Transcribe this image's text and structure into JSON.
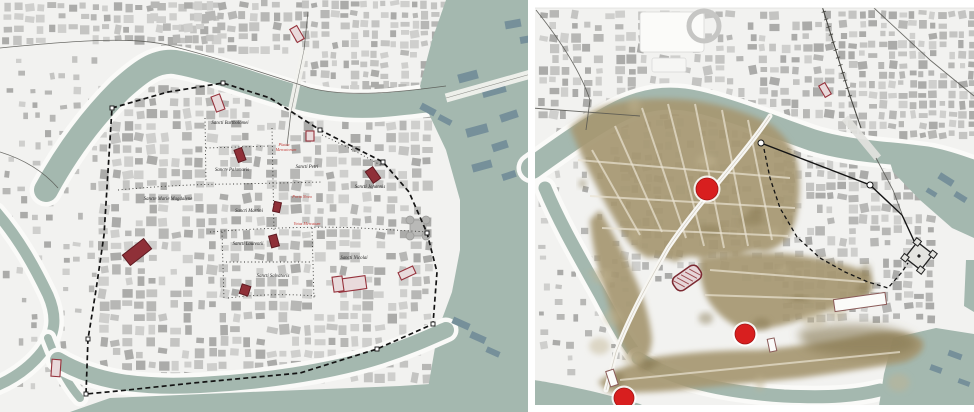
{
  "figure": {
    "kind": "historical-city-map-comparison",
    "panel_count": 2
  },
  "colors": {
    "land": "#f2f2f0",
    "water": "#a4b8af",
    "water_dark": "#7e97a0",
    "bank": "#fafaf8",
    "building_palette": [
      "#cfcfcd",
      "#c4c4c2",
      "#b7b7b5",
      "#ababa9"
    ],
    "building_dark_teal": "#76909a",
    "sepia": "#a79872",
    "sepia_dark": "#86774f",
    "sepia_street": "#eae3d1",
    "church_fill": "#8f3038",
    "church_stroke": "#5f1b22",
    "red_outline": "#96323c",
    "marker_red": "#d81f1f",
    "label_black": "#1e1e1e",
    "label_red": "#c33a35",
    "wall": "#141414",
    "road": "#555550",
    "divider": "#ffffff"
  },
  "left_panel": {
    "name": "medieval-parish-map",
    "labels": [
      {
        "text": "Sancti Bartholomei",
        "x": 230,
        "y": 124,
        "red": false
      },
      {
        "text": "Sancte Palamaris",
        "x": 232,
        "y": 171,
        "red": false
      },
      {
        "text": "Sancti Petri",
        "x": 307,
        "y": 168,
        "red": false
      },
      {
        "text": "Sancti Johannis",
        "x": 370,
        "y": 188,
        "red": false
      },
      {
        "text": "Sancte Marie Magdalene",
        "x": 168,
        "y": 200,
        "red": false
      },
      {
        "text": "Sancti Martini",
        "x": 249,
        "y": 212,
        "red": false
      },
      {
        "text": "Sancti Laurentii",
        "x": 248,
        "y": 245,
        "red": false
      },
      {
        "text": "Sancti Salvatoris",
        "x": 273,
        "y": 277,
        "red": false
      },
      {
        "text": "Sancti Nicolai",
        "x": 354,
        "y": 259,
        "red": false
      },
      {
        "text": "Platea",
        "x": 284,
        "y": 146,
        "red": true
      },
      {
        "text": "Mercatorum",
        "x": 286,
        "y": 151,
        "red": true
      },
      {
        "text": "Porta Nova",
        "x": 302,
        "y": 198,
        "red": true
      },
      {
        "text": "Vetus Mercatum",
        "x": 307,
        "y": 225,
        "red": true
      }
    ],
    "wall_path": "M112,108 L168,92 L223,83 L270,98 L320,130 L383,162 L409,192 L427,233 L437,272 L433,324 L377,349 L300,373 L193,383 L118,391 L86,394 L88,339 L96,290 L104,235 Z",
    "wall_markers": [
      [
        112,
        108
      ],
      [
        223,
        83
      ],
      [
        320,
        130
      ],
      [
        383,
        162
      ],
      [
        427,
        233
      ],
      [
        433,
        324
      ],
      [
        377,
        349
      ],
      [
        86,
        394
      ],
      [
        88,
        339
      ]
    ],
    "dotted_lines": [
      "M205,118 L206,182",
      "M118,190 C160,186 200,184 238,184 L322,182",
      "M272,128 L274,232",
      "M210,232 C260,228 320,226 360,228 L428,232",
      "M222,232 L224,300",
      "M312,228 L314,300",
      "M226,262 L310,262",
      "M228,298 C260,294 290,294 316,296",
      "M322,135 C350,148 368,158 382,166",
      "M206,148 L270,146"
    ],
    "water": {
      "main_river": "M46,190 C65,155 90,120 120,90 C140,72 155,60 175,62 C210,68 250,84 300,98 C330,106 360,108 395,104 C415,102 430,100 448,98",
      "east_body": "M446,0 L531,0 L531,412 L424,412 L438,330 L452,292 L460,250 L460,200 L446,150 L428,112 L420,86 L432,40 Z",
      "west_channel": "M-4,212 C20,240 35,268 48,295 C58,318 55,335 42,352 C30,367 15,378 -4,386",
      "channel_link": "M48,338 C58,364 66,382 80,398",
      "south_moat": "M58,360 C95,382 140,388 200,385 C260,382 330,372 380,356 C408,347 428,338 446,330",
      "south_edge": "M70,412 L110,398 L250,392 L400,386 L460,382 L531,384 L531,412 Z"
    },
    "bridges": [
      {
        "path": "M304,50 L291,112",
        "w": 7
      },
      {
        "path": "M446,98 L531,74",
        "w": 9
      }
    ],
    "roads": [
      "M0,48 C80,40 140,36 175,47 C215,57 260,72 310,88 C350,98 400,92 446,86",
      "M308,12 L304,50",
      "M291,112 L287,146",
      "M0,152 C26,160 44,172 58,188"
    ],
    "churches_filled": [
      {
        "x": 137,
        "y": 252,
        "w": 27,
        "h": 13,
        "r": -38
      },
      {
        "x": 240,
        "y": 155,
        "w": 8,
        "h": 13,
        "r": -20
      },
      {
        "x": 277,
        "y": 207,
        "w": 7,
        "h": 10,
        "r": 12
      },
      {
        "x": 274,
        "y": 241,
        "w": 8,
        "h": 12,
        "r": -15
      },
      {
        "x": 245,
        "y": 290,
        "w": 9,
        "h": 10,
        "r": 18
      },
      {
        "x": 373,
        "y": 175,
        "w": 9,
        "h": 14,
        "r": -35
      }
    ],
    "churches_outline": [
      {
        "x": 218,
        "y": 103,
        "w": 9,
        "h": 16,
        "r": -20
      },
      {
        "x": 297,
        "y": 34,
        "w": 8,
        "h": 15,
        "r": -30
      },
      {
        "x": 310,
        "y": 136,
        "w": 8,
        "h": 10,
        "r": 0
      },
      {
        "x": 56,
        "y": 368,
        "w": 9,
        "h": 17,
        "r": 4
      },
      {
        "x": 407,
        "y": 273,
        "w": 16,
        "h": 8,
        "r": -25
      },
      {
        "x": 352,
        "y": 284,
        "w": 28,
        "h": 13,
        "r": -8
      },
      {
        "x": 338,
        "y": 284,
        "w": 10,
        "h": 15,
        "r": -8
      }
    ],
    "dark_water_buildings": [
      [
        458,
        72,
        20,
        9,
        -15
      ],
      [
        482,
        86,
        24,
        9,
        -15
      ],
      [
        500,
        112,
        18,
        8,
        -18
      ],
      [
        466,
        126,
        22,
        9,
        -15
      ],
      [
        492,
        142,
        16,
        8,
        -18
      ],
      [
        472,
        162,
        20,
        8,
        -15
      ],
      [
        502,
        172,
        14,
        7,
        -18
      ],
      [
        420,
        106,
        16,
        7,
        28
      ],
      [
        438,
        117,
        14,
        6,
        28
      ],
      [
        452,
        320,
        18,
        7,
        24
      ],
      [
        470,
        334,
        16,
        7,
        24
      ],
      [
        486,
        349,
        14,
        6,
        24
      ],
      [
        505,
        20,
        16,
        8,
        -10
      ],
      [
        520,
        36,
        12,
        7,
        -10
      ]
    ],
    "castle": {
      "x": 418,
      "y": 228
    }
  },
  "right_panel": {
    "name": "aerial-overlay-map",
    "markers": [
      {
        "x": 707,
        "y": 189,
        "r": 11
      },
      {
        "x": 745,
        "y": 334,
        "r": 10
      },
      {
        "x": 624,
        "y": 398,
        "r": 10
      }
    ],
    "hatched_church": {
      "x": 687,
      "y": 278,
      "w": 30,
      "h": 16,
      "r": -35
    },
    "churches_outline": [
      {
        "x": 825,
        "y": 90,
        "w": 7,
        "h": 13,
        "r": -30
      }
    ],
    "white_buildings": [
      {
        "x": 612,
        "y": 378,
        "w": 8,
        "h": 16,
        "r": -18
      },
      {
        "x": 772,
        "y": 345,
        "w": 7,
        "h": 13,
        "r": -12
      },
      {
        "x": 860,
        "y": 302,
        "w": 52,
        "h": 12,
        "r": -8
      }
    ],
    "wall_solid": "M761,143 L870,185 L902,215 L915,243",
    "wall_solid_markers": [
      [
        761,
        143
      ],
      [
        870,
        185
      ]
    ],
    "wall_dashed": "M764,149 L770,178 L780,208 L797,237 L820,258 L845,272 L868,282 L888,288 L902,272 L908,263",
    "citadel": {
      "x": 919,
      "y": 256,
      "size": 20,
      "rot": 38
    },
    "water": {
      "main_river": "M532,168 C560,148 588,128 614,114 C642,99 668,95 698,102 C732,110 772,126 812,140 C850,152 890,152 930,158 C950,162 965,168 976,172",
      "main_end": "M885,146 L930,150 L974,164 L974,238 L952,228 L920,200 L893,172 Z",
      "west_arm": "M545,188 C560,224 580,258 600,294 C614,320 625,342 640,360",
      "south_arm": "M638,358 C676,382 724,392 784,396 C830,398 856,396 880,390",
      "southwest_edge": "M534,412 L534,380 C560,384 600,392 640,404 L656,412 Z",
      "east_strip": "M966,260 L974,260 L974,312 L964,306 Z",
      "southeast_body": "M893,338 L936,328 L974,334 L974,412 L878,412 L884,374 Z"
    },
    "sepia_regions": [
      "M570,128 Q585,112 610,104 Q645,96 690,100 Q735,106 770,124 Q792,140 798,165 Q802,195 795,222 Q788,246 765,252 Q748,248 738,258 Q720,252 705,260 Q688,252 676,262 Q660,255 648,258 Q632,250 622,232 Q608,210 596,185 Q582,158 570,128 Z",
      "M600,210 Q622,248 638,285 Q650,315 652,340 Q650,358 640,368 Q628,360 620,340 Q610,310 600,275 Q592,245 590,220 Z",
      "M700,258 Q740,250 790,254 Q835,260 868,272 Q880,286 862,300 Q832,310 800,320 Q770,330 745,330 Q722,322 708,300 Q698,280 700,258 Z",
      "M598,382 Q620,366 650,358 Q700,350 760,350 Q820,344 868,334 Q905,328 922,340 Q928,352 905,362 Q860,370 800,378 Q740,384 680,390 Q635,394 608,392 Z"
    ],
    "sepia_dark_blob": "M800,330 Q840,322 880,326 Q912,332 918,344 Q910,356 880,356 Q840,358 812,350 Q796,342 800,330 Z",
    "sepia_streets": [
      "M592,150 L640,235",
      "M615,126 L662,232",
      "M642,108 L686,238",
      "M668,104 L704,246",
      "M695,104 L724,248",
      "M722,110 L748,246",
      "M748,120 L772,240",
      "M578,160 L790,178",
      "M590,196 L795,208",
      "M602,228 L788,236",
      "M710,270 L865,282",
      "M705,295 L860,300",
      "M620,380 L900,352"
    ],
    "white_road": "M770,116 C742,158 700,200 668,248 C645,288 628,320 616,352 L606,390",
    "railway": "M822,6 L850,96 L861,128",
    "rail_bridge": "M845,118 L878,158",
    "roads": [
      "M536,10 C560,40 580,70 590,100 L586,130",
      "M532,108 L640,116",
      "M874,8 L930,60 L974,96",
      "M876,158 L893,190 L902,214"
    ],
    "stadium": {
      "slab": [
        640,
        12,
        64,
        40
      ],
      "ring": [
        704,
        26,
        15
      ],
      "annex": [
        652,
        58,
        34,
        14
      ]
    },
    "dark_water_buildings": [
      [
        938,
        176,
        16,
        7,
        32
      ],
      [
        954,
        194,
        13,
        6,
        32
      ],
      [
        926,
        190,
        11,
        5,
        32
      ],
      [
        948,
        352,
        14,
        6,
        20
      ],
      [
        930,
        366,
        12,
        6,
        20
      ],
      [
        958,
        380,
        12,
        5,
        20
      ]
    ]
  },
  "layout_bands": {
    "divider_x": 528,
    "divider_w": 7,
    "right_top_band_h": 8,
    "right_bottom_band_y": 405
  }
}
